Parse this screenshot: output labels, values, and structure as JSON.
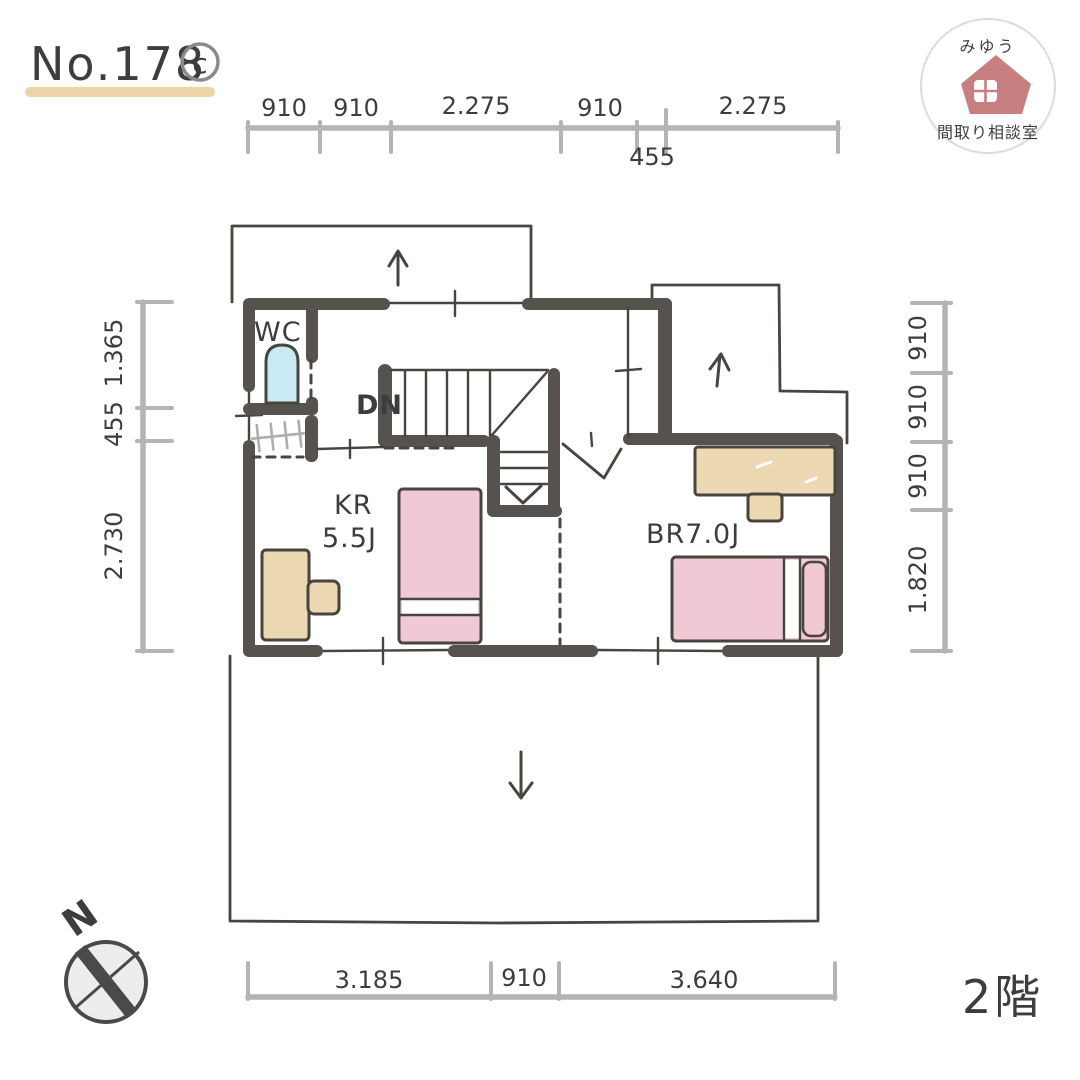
{
  "title": {
    "number": "No.178",
    "copyright_mark": "c"
  },
  "floor_label": "2階",
  "logo": {
    "name_top": "みゆう",
    "name_bottom": "間取り相談室",
    "icon": "house-icon"
  },
  "compass": {
    "north_label": "N"
  },
  "rooms": {
    "wc_label": "WC",
    "stairs_down_label": "DN",
    "kids_room_line1": "KR",
    "kids_room_line2": "5.5J",
    "bedroom_label": "BR7.0J"
  },
  "dimensions": {
    "top": [
      "910",
      "910",
      "2.275",
      "910",
      "2.275"
    ],
    "top_below": "455",
    "left": [
      "1.365",
      "455",
      "2.730"
    ],
    "right": [
      "910",
      "910",
      "910",
      "1.820"
    ],
    "bottom": [
      "3.185",
      "910",
      "3.640"
    ]
  },
  "colors": {
    "wall": "#56524e",
    "line": "#48443f",
    "dim": "#b4b4b4",
    "dimtext": "#3d3d3d",
    "pink": "#f1c9d5",
    "tan": "#ecd8b2",
    "blue": "#c7eaf3",
    "logored": "#c77f7f",
    "underline": "#ecd6a9",
    "titlegray": "#8a8a8a",
    "hatch": "#aeaeae",
    "compassfill": "#ededed"
  }
}
